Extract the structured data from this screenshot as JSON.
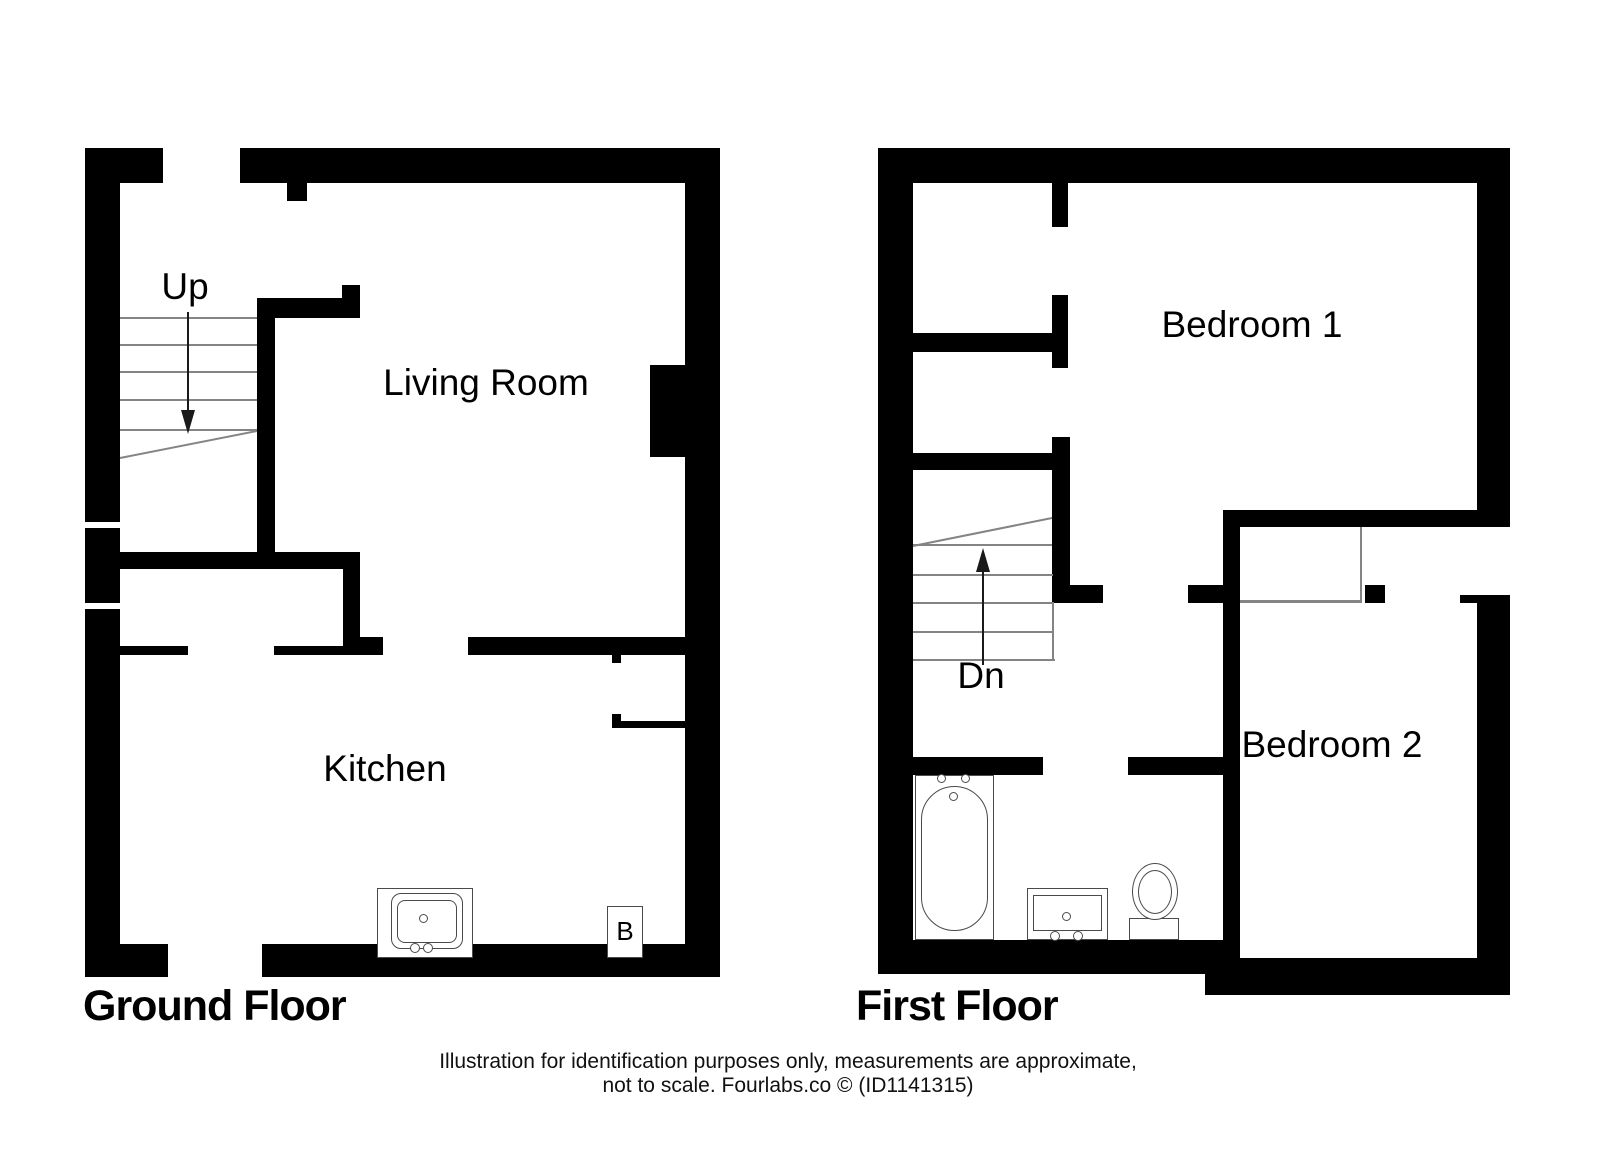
{
  "ground_floor": {
    "title": "Ground Floor",
    "stair_label": "Up",
    "living_room_label": "Living Room",
    "kitchen_label": "Kitchen",
    "boiler_label": "B"
  },
  "first_floor": {
    "title": "First Floor",
    "stair_label": "Dn",
    "bedroom1_label": "Bedroom 1",
    "bedroom2_label": "Bedroom 2"
  },
  "footer": {
    "line1": "Illustration for identification purposes only, measurements are approximate,",
    "line2": "not to scale. Fourlabs.co © (ID1141315)"
  },
  "colors": {
    "wall": "#000000",
    "background": "#ffffff",
    "fixture_line": "#4a4a4a",
    "stair_line": "#848484"
  }
}
